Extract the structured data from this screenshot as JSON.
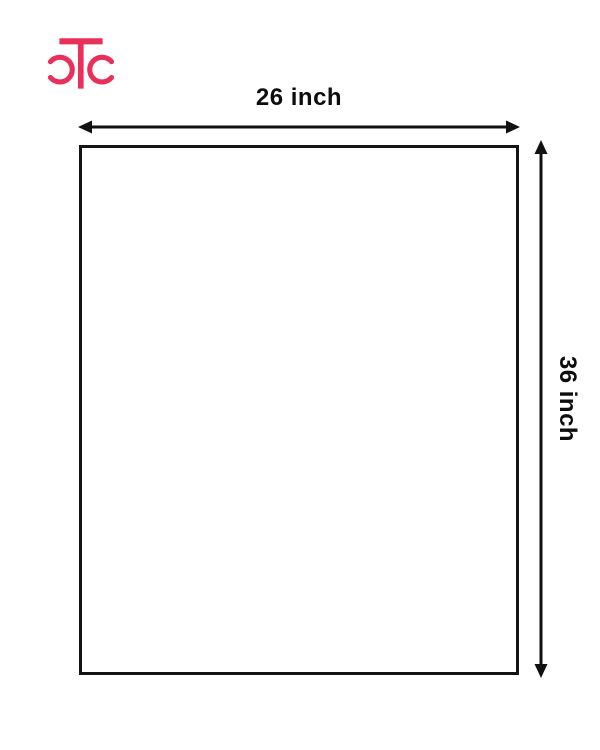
{
  "page": {
    "background": "#ffffff"
  },
  "logo": {
    "text": "CTC",
    "color": "#E8305A"
  },
  "diagram": {
    "shape": "rectangle",
    "width_label": "26 inch",
    "height_label": "36 inch",
    "line_color": "#111111",
    "fill_color": "#ffffff"
  }
}
